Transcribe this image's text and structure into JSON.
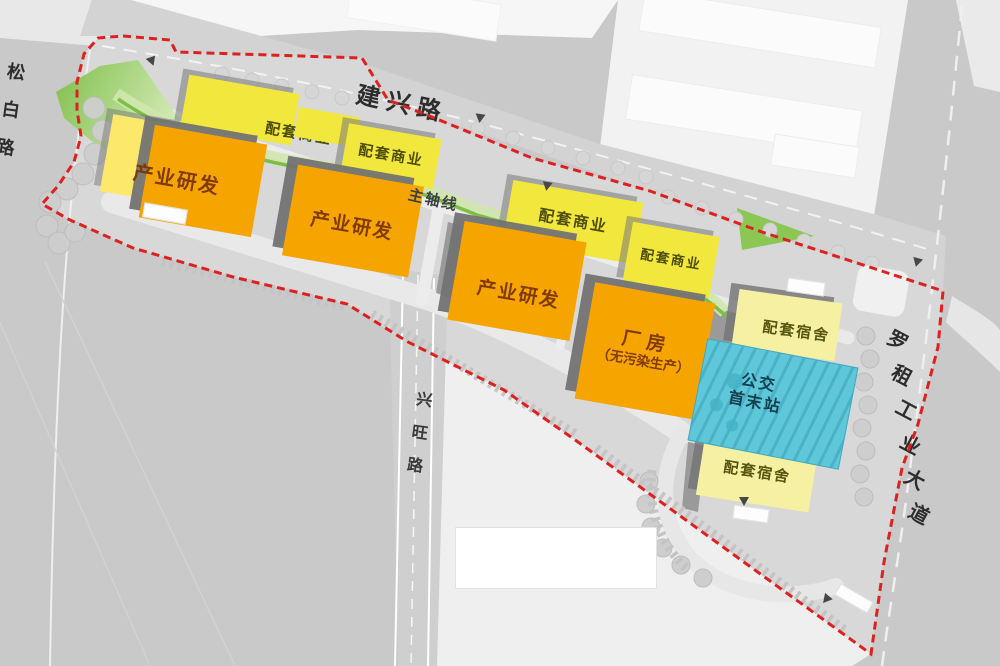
{
  "roads": {
    "top": "建兴路",
    "left": "松白路",
    "center": "兴旺路",
    "right": "罗租工业大道"
  },
  "axis_label": "主轴线",
  "site": {
    "boundary_color": "#dd2020",
    "boundary_style": "dashed"
  },
  "colors": {
    "research_orange": "#f6a500",
    "commercial_yellow": "#f2e73c",
    "dormitory_pale_yellow": "#f6f0a2",
    "bus_cyan": "#5ec7da",
    "greenway_green": "#7dbe49",
    "boundary_red": "#dd2020"
  },
  "buildings": [
    {
      "label": "配套商业",
      "type": "commercial"
    },
    {
      "label": "产业研发",
      "type": "research"
    },
    {
      "label": "配套商业",
      "type": "commercial"
    },
    {
      "label": "产业研发",
      "type": "research"
    },
    {
      "label": "配套商业",
      "type": "commercial"
    },
    {
      "label": "配套商业",
      "type": "commercial"
    },
    {
      "label": "产业研发",
      "type": "research"
    },
    {
      "label": "厂房",
      "sublabel": "（无污染生产）",
      "type": "factory"
    },
    {
      "label": "配套宿舍",
      "type": "dormitory"
    },
    {
      "label": "公交",
      "label2": "首末站",
      "type": "bus-terminal"
    },
    {
      "label": "配套宿舍",
      "type": "dormitory"
    }
  ]
}
